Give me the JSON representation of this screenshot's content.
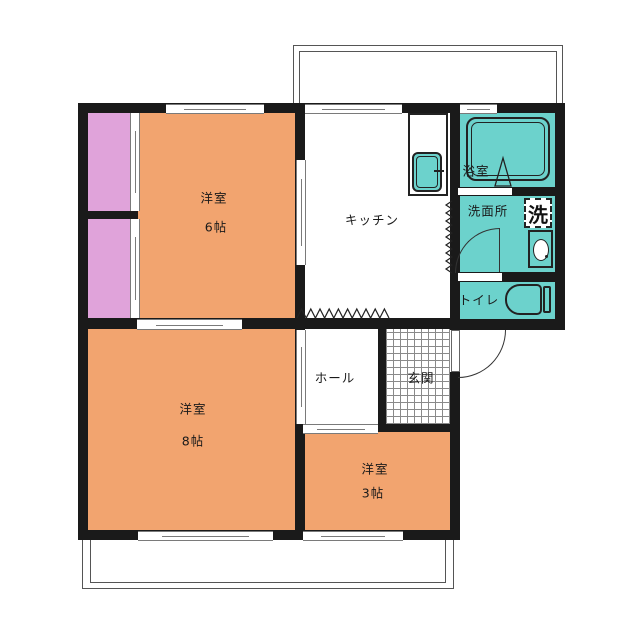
{
  "floorplan": {
    "rooms": {
      "bedroom6": {
        "name": "洋室",
        "size": "6帖"
      },
      "bedroom8": {
        "name": "洋室",
        "size": "8帖"
      },
      "bedroom3": {
        "name": "洋室",
        "size": "3帖"
      },
      "kitchen": {
        "name": "キッチン"
      },
      "bath": {
        "name": "浴室"
      },
      "washroom": {
        "name": "洗面所"
      },
      "toilet": {
        "name": "トイレ"
      },
      "hall": {
        "name": "ホール"
      },
      "entrance": {
        "name": "玄関"
      },
      "washer": {
        "label": "洗"
      }
    },
    "colors": {
      "room_orange": "#F2A46F",
      "closet_pink": "#E0A3DA",
      "wet_area_teal": "#6CD2CC",
      "wall_black": "#1a1a1a",
      "window_gray": "#7a7a7a"
    }
  }
}
